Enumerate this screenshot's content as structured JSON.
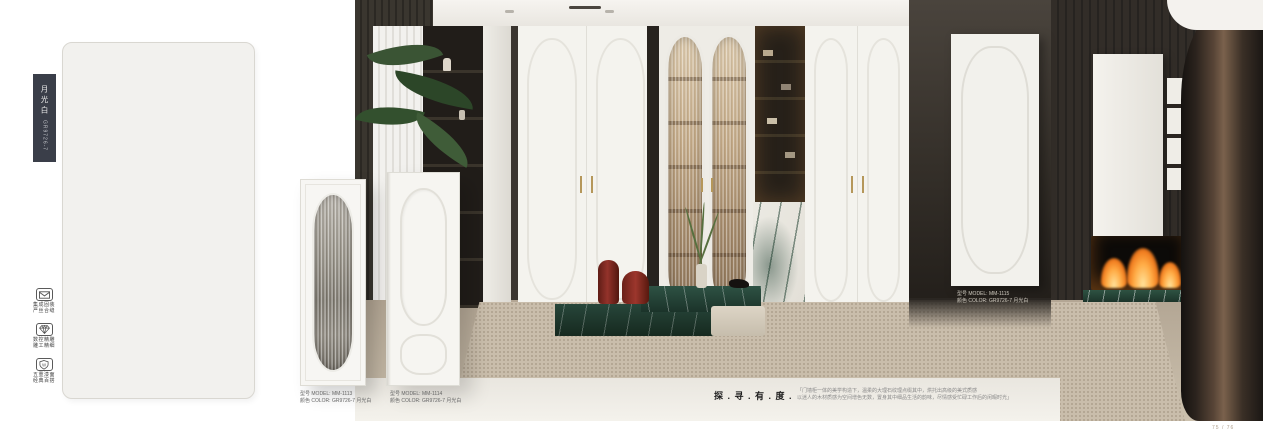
{
  "page": {
    "footer": "75 / 76"
  },
  "swatch": {
    "name": "月光白",
    "code": "GR9726-7"
  },
  "features": [
    {
      "icon": "envelope-icon",
      "line1": "集成固装",
      "line2": "严丝合缝"
    },
    {
      "icon": "diamond-icon",
      "line1": "数控精雕",
      "line2": "雕工精细"
    },
    {
      "icon": "shield-icon",
      "line1": "五重漆面",
      "line2": "经典百搭"
    }
  ],
  "products": [
    {
      "model": "型号 MODEL: MM-1113",
      "color": "颜色 COLOR: GR9726-7 月光白"
    },
    {
      "model": "型号 MODEL: MM-1114",
      "color": "颜色 COLOR: GR9726-7 月光白"
    },
    {
      "model": "型号 MODEL: MM-1115",
      "color": "颜色 COLOR: GR9726-7 月光白"
    }
  ],
  "tagline": "探 . 寻 . 有 . 度 .",
  "description": {
    "line1": "「门墙柜一体的美学构造下，温柔的大理石纹理点缀其中，烘托出高级的美式质感",
    "line2": "以迷人的木材质感为空间增色无数，置身其中细品生活的韵味，尽情感受忙碌工作后的闲暇时光」"
  },
  "colors": {
    "swatch_tag_bg": "#3a3e49",
    "panel_fill": "#f2f1ee",
    "gold_handle": "#b5975a",
    "marble_green": "#1e3a2f",
    "stool_red": "#7c241c",
    "carpet_beige": "#c9bdab",
    "wood_dark": "#2b2723",
    "flame_orange": "#ff9b3a"
  }
}
